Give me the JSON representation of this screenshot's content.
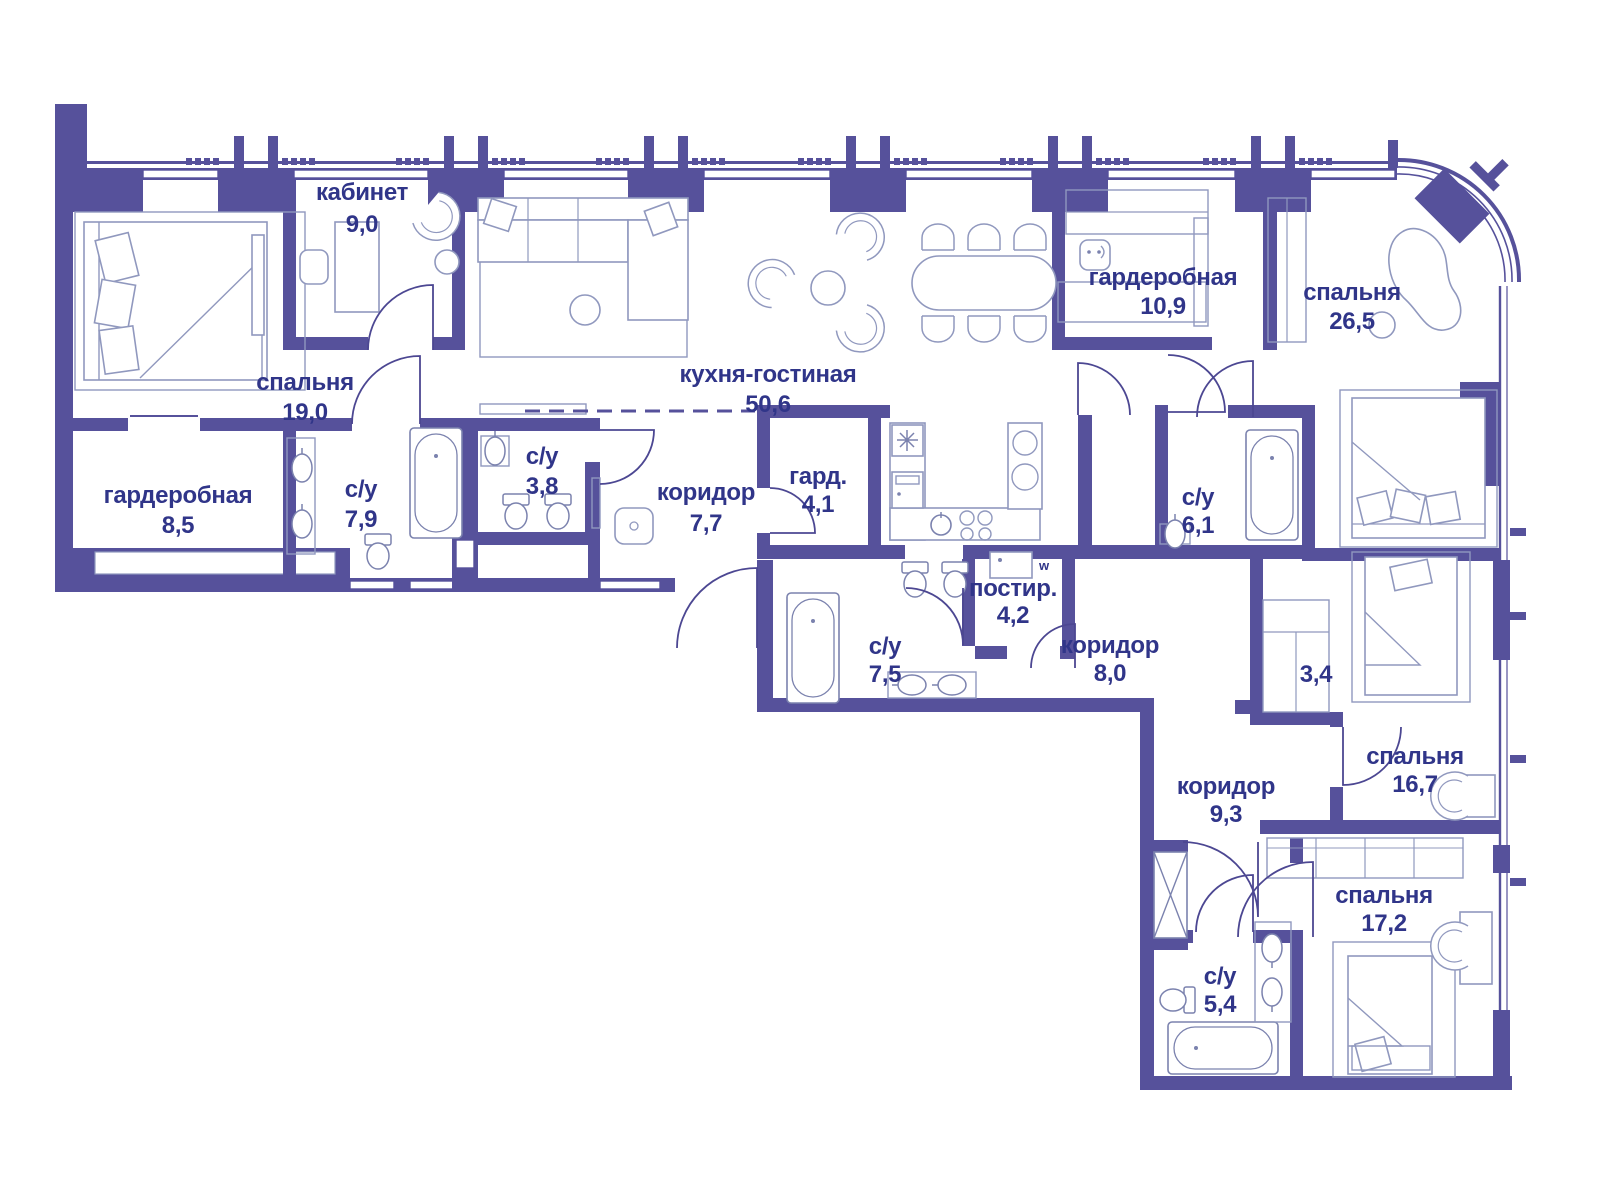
{
  "plan": {
    "type": "apartment-floor-plan",
    "language": "ru",
    "colors": {
      "wall": "#56519B",
      "text": "#303589",
      "furniture_line": "#9098BE",
      "background": "#FFFFFF"
    },
    "annotations": {
      "washer": "w"
    },
    "rooms": [
      {
        "name": "кабинет",
        "area": "9,0"
      },
      {
        "name": "спальня",
        "area": "19,0"
      },
      {
        "name": "гардеробная",
        "area": "8,5"
      },
      {
        "name": "с/у",
        "area": "7,9"
      },
      {
        "name": "с/у",
        "area": "3,8"
      },
      {
        "name": "коридор",
        "area": "7,7"
      },
      {
        "name": "гард.",
        "area": "4,1"
      },
      {
        "name": "кухня-гостиная",
        "area": "50,6"
      },
      {
        "name": "гардеробная",
        "area": "10,9"
      },
      {
        "name": "спальня",
        "area": "26,5"
      },
      {
        "name": "с/у",
        "area": "6,1"
      },
      {
        "name": "с/у",
        "area": "7,5"
      },
      {
        "name": "постир.",
        "area": "4,2"
      },
      {
        "name": "коридор",
        "area": "8,0"
      },
      {
        "name": "",
        "area": "3,4"
      },
      {
        "name": "спальня",
        "area": "16,7"
      },
      {
        "name": "коридор",
        "area": "9,3"
      },
      {
        "name": "спальня",
        "area": "17,2"
      },
      {
        "name": "с/у",
        "area": "5,4"
      }
    ]
  }
}
